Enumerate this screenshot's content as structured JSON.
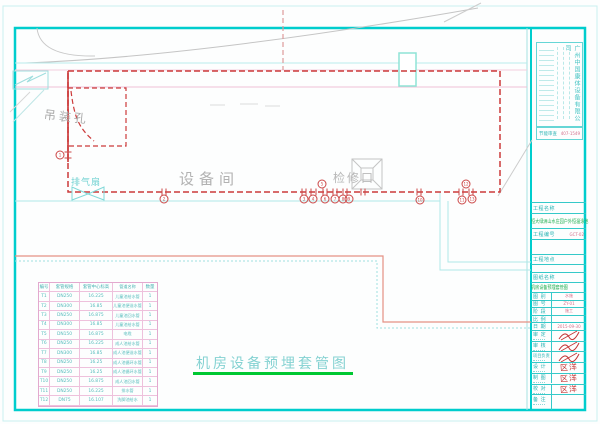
{
  "colors": {
    "accent_cyan": "#00c8c8",
    "dash_red": "#cc3a3a",
    "title_green": "#00c832",
    "salmon": "#e59184",
    "table_pink": "#e3a9cf"
  },
  "company_block": {
    "name_vertical": "广州中国康体设备有限公司",
    "cert_label": "节能审查",
    "cert_no": "407-1549"
  },
  "titleblock": {
    "project_name_label": "工程名称",
    "project_name_full": "恒大绿洲山水庄园户外恒温泳池",
    "project_no_label": "工程编号",
    "project_no_value": "GCT-02",
    "project_loc_label": "工程地点",
    "project_loc_value": "",
    "drawing_name_label": "图纸名称",
    "drawing_name": "机房设备预埋套管图",
    "meta": [
      {
        "label": "图 别",
        "value": "水施"
      },
      {
        "label": "图 号",
        "value": "ZY-01"
      },
      {
        "label": "阶 段",
        "value": "施工"
      },
      {
        "label": "比 例",
        "value": ""
      },
      {
        "label": "日 期",
        "value": "2015-09-30"
      }
    ],
    "signs": [
      {
        "label": "审 定",
        "sig": ""
      },
      {
        "label": "审 核",
        "sig": ""
      },
      {
        "label": "项目负责",
        "sig": ""
      },
      {
        "label": "设 计",
        "sig": "区洋"
      },
      {
        "label": "制 图",
        "sig": "区洋"
      },
      {
        "label": "校 对",
        "sig": "区洋"
      }
    ],
    "note_label": "备 注"
  },
  "drawing": {
    "room_label": "设备间",
    "hoist_label": "吊装孔",
    "exhaust_label": "排气扇",
    "hatch_label": "检修口",
    "title": "机房设备预埋套管图",
    "markers": [
      {
        "x": 60,
        "y": 155,
        "n": "1"
      },
      {
        "x": 164,
        "y": 199,
        "n": "2"
      },
      {
        "x": 304,
        "y": 199,
        "n": "3"
      },
      {
        "x": 313,
        "y": 199,
        "n": "4"
      },
      {
        "x": 322,
        "y": 184,
        "n": "5"
      },
      {
        "x": 325,
        "y": 199,
        "n": "6"
      },
      {
        "x": 335,
        "y": 199,
        "n": "7"
      },
      {
        "x": 343,
        "y": 199,
        "n": "8"
      },
      {
        "x": 349,
        "y": 199,
        "n": "9"
      },
      {
        "x": 420,
        "y": 200,
        "n": "10"
      },
      {
        "x": 462,
        "y": 200,
        "n": "11"
      },
      {
        "x": 466,
        "y": 184,
        "n": "12"
      },
      {
        "x": 472,
        "y": 199,
        "n": "13"
      }
    ],
    "ticks": [
      162,
      166,
      302,
      306,
      311,
      316,
      323,
      327,
      333,
      337,
      343,
      347,
      361,
      365,
      417,
      421,
      459,
      463,
      469,
      473
    ]
  },
  "table": {
    "headers": [
      "编号",
      "套管规格",
      "套管中心标高",
      "管道名称",
      "数量"
    ],
    "rows": [
      [
        "T1",
        "DN250",
        "16.225",
        "儿童池给水管",
        "1"
      ],
      [
        "T2",
        "DN300",
        "16.85",
        "儿童池便溢水管",
        "1"
      ],
      [
        "T3",
        "DN250",
        "16.875",
        "儿童池回水管",
        "1"
      ],
      [
        "T4",
        "DN300",
        "16.85",
        "儿童池给水管",
        "1"
      ],
      [
        "T5",
        "DN150",
        "16.875",
        "电缆",
        "1"
      ],
      [
        "T6",
        "DN250",
        "16.225",
        "成人池给水管",
        "1"
      ],
      [
        "T7",
        "DN300",
        "16.85",
        "成人池便溢水管",
        "1"
      ],
      [
        "T8",
        "DN250",
        "16.25",
        "成人池循环水管",
        "1"
      ],
      [
        "T9",
        "DN250",
        "16.25",
        "成人池循环水管",
        "1"
      ],
      [
        "T10",
        "DN250",
        "16.875",
        "成人池回水管",
        "1"
      ],
      [
        "T11",
        "DN250",
        "16.225",
        "排水管",
        "1"
      ],
      [
        "T12",
        "DN75",
        "16.107",
        "洗脚池给水",
        "1"
      ]
    ]
  }
}
